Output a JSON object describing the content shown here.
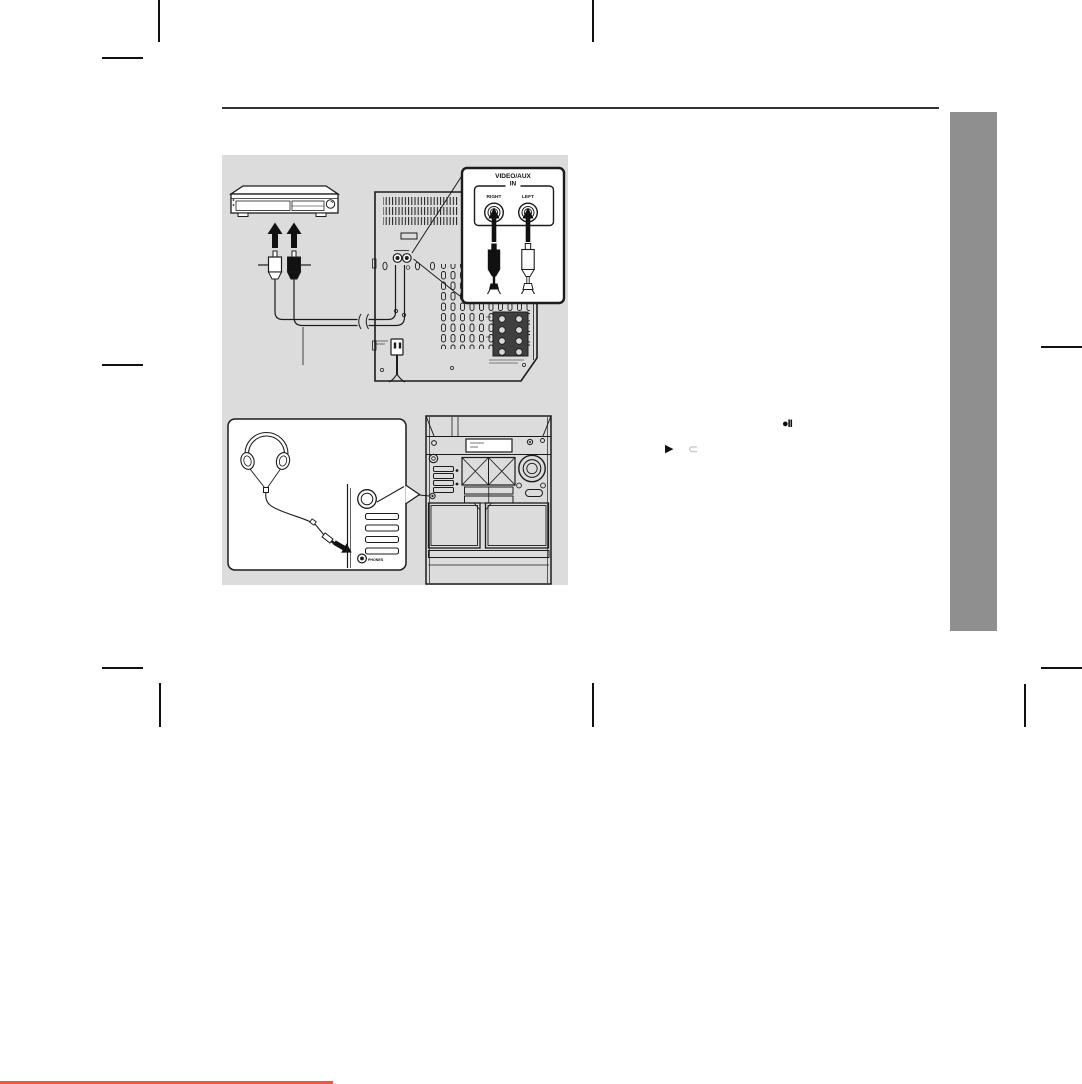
{
  "page": {
    "type": "manual-page-scan",
    "background": "#ffffff",
    "accent_red": "#e8584c",
    "sidebar_gray": "#8f8f8f",
    "panel_gray": "#dcdcdc",
    "line_black": "#1c1c1c"
  },
  "diagram": {
    "videoaux_callout": {
      "title_line1": "VIDEO/AUX",
      "title_line2": "IN",
      "left_jack_label": "RIGHT",
      "right_jack_label": "LEFT"
    },
    "phones_callout": {
      "jack_label": "PHONES"
    }
  },
  "inline_symbols": {
    "rec_pause": "●II",
    "play": "▶",
    "tape_direction": "⊂"
  }
}
